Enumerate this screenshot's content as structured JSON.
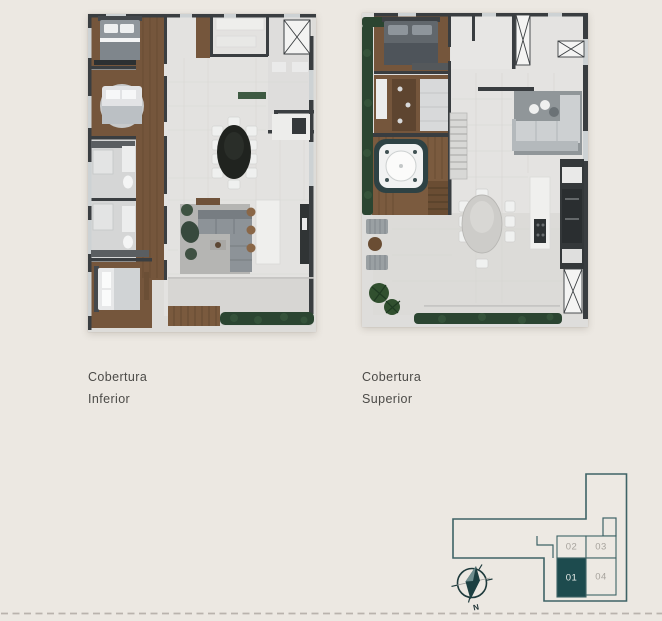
{
  "canvas": {
    "width": 662,
    "height": 621,
    "background": "#ECE8E2"
  },
  "plans": [
    {
      "id": "cobertura-inferior",
      "label_lines": [
        "Cobertura",
        "Inferior"
      ]
    },
    {
      "id": "cobertura-superior",
      "label_lines": [
        "Cobertura",
        "Superior"
      ]
    }
  ],
  "site_plan": {
    "units": [
      {
        "number": "02",
        "highlighted": false
      },
      {
        "number": "03",
        "highlighted": false
      },
      {
        "number": "01",
        "highlighted": true
      },
      {
        "number": "04",
        "highlighted": false
      }
    ],
    "colors": {
      "outline": "#3E6366",
      "highlight_fill": "#1D4B4E",
      "unit_text": "#A7A39D",
      "highlight_text": "#E9EDEA"
    }
  },
  "compass": {
    "label": "N"
  },
  "footer_divider": {
    "style": "dashed",
    "color": "#B9B3AD"
  }
}
